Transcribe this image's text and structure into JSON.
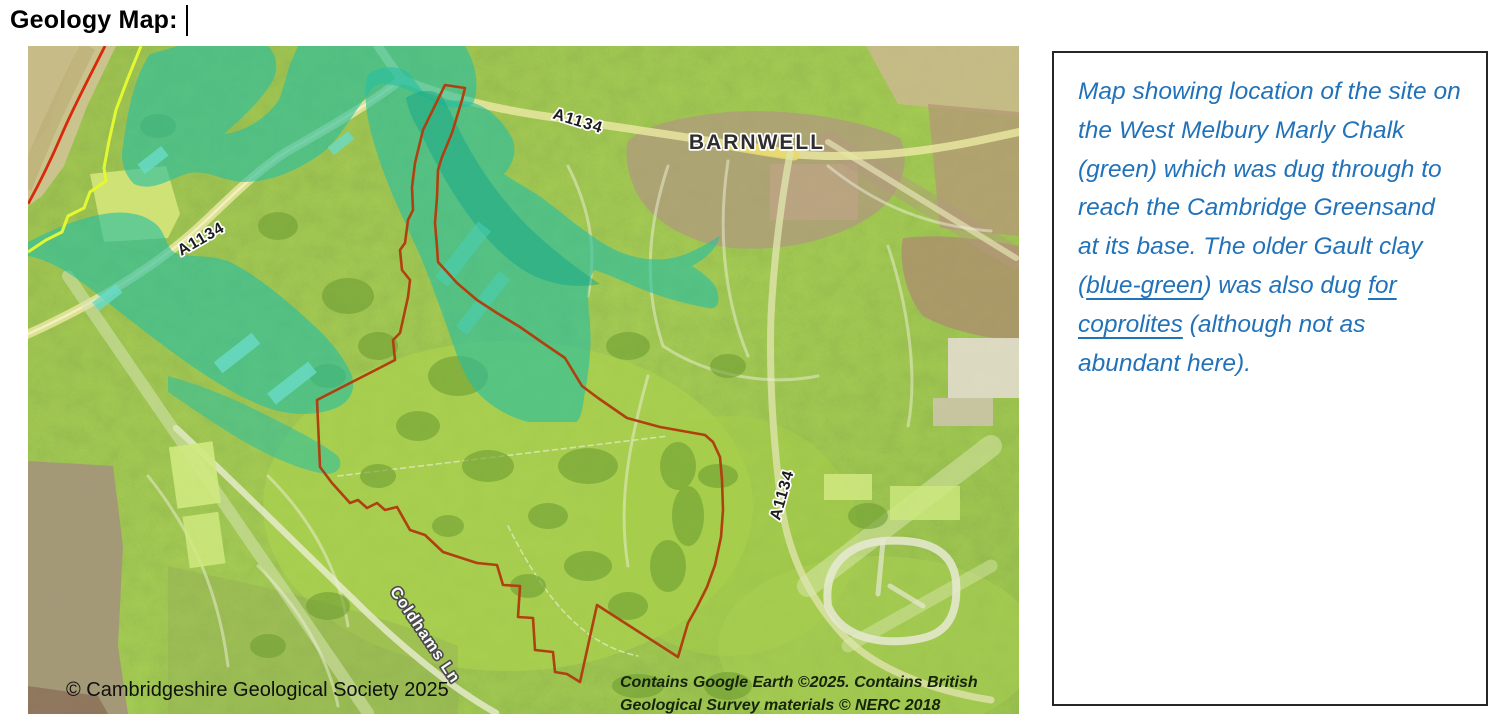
{
  "page": {
    "title": "Geology Map:"
  },
  "map": {
    "labels": {
      "road_a1134_west": "A1134",
      "road_a1134_north": "A1134",
      "road_a1134_east": "A1134",
      "town_barnwell": "BARNWELL",
      "coldhams_lane": "Coldhams Ln"
    },
    "copyright": "© Cambridgeshire Geological Society 2025",
    "attribution_line1": "Contains Google Earth ©2025. Contains British",
    "attribution_line2": "Geological Survey materials © NERC 2018",
    "colors": {
      "chalk_green_overlay": "#a0c84a",
      "gault_teal_overlay": "#27bfa2",
      "site_boundary_red": "#b0400f",
      "geology_line_red": "#d8290b",
      "geology_line_yellow": "#e4f832",
      "caption_blue": "#2272b9"
    }
  },
  "caption": {
    "parts": [
      {
        "text": "Map showing location of the site on the West Melbury Marly Chalk (green) which was dug through to reach the Cambridge Greensand at its base. The older Gault clay ("
      },
      {
        "text": "blue-green"
      },
      {
        "text": ") was also dug "
      },
      {
        "text": "for coprolites"
      },
      {
        "text": " (although not as abundant here)."
      }
    ]
  }
}
